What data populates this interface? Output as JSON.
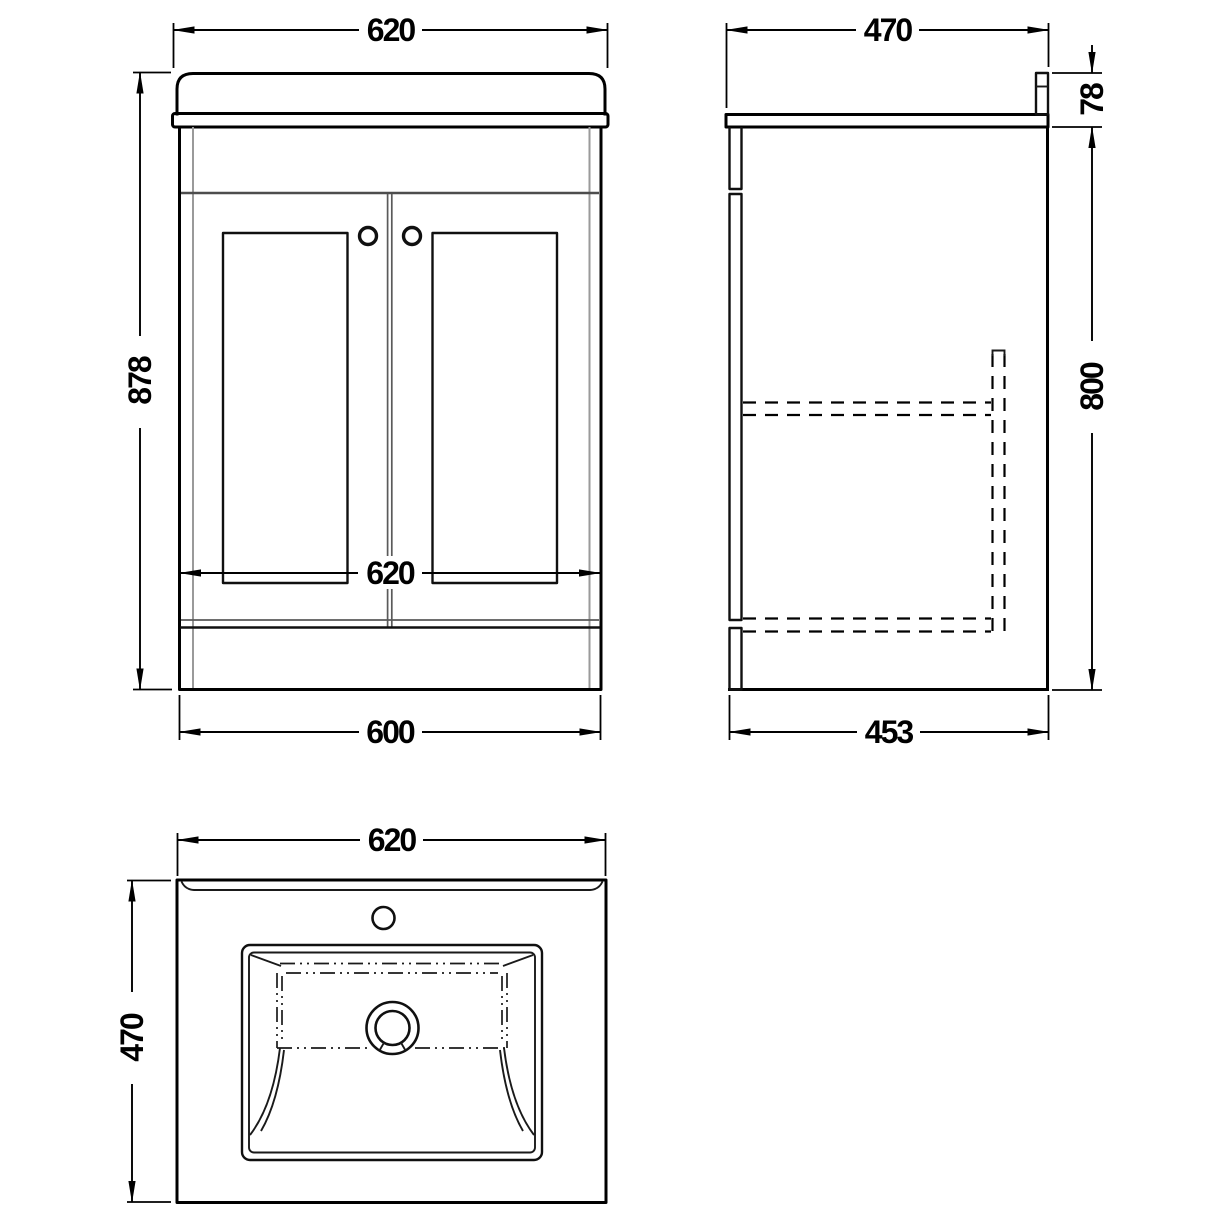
{
  "drawing": {
    "subject": "vanity-unit-technical-drawing",
    "units": "mm",
    "background": "#ffffff",
    "line_color": "#000000",
    "secondary_line_color": "#9a9a9a",
    "views": {
      "front": {
        "name": "front-elevation",
        "dims": {
          "top_width": "620",
          "overall_height": "878",
          "mid_width": "620",
          "base_width": "600"
        }
      },
      "side": {
        "name": "side-elevation",
        "dims": {
          "top_depth": "470",
          "worktop_height": "78",
          "cabinet_height": "800",
          "base_depth": "453"
        }
      },
      "plan": {
        "name": "plan-view",
        "dims": {
          "width": "620",
          "depth": "470"
        }
      }
    }
  }
}
